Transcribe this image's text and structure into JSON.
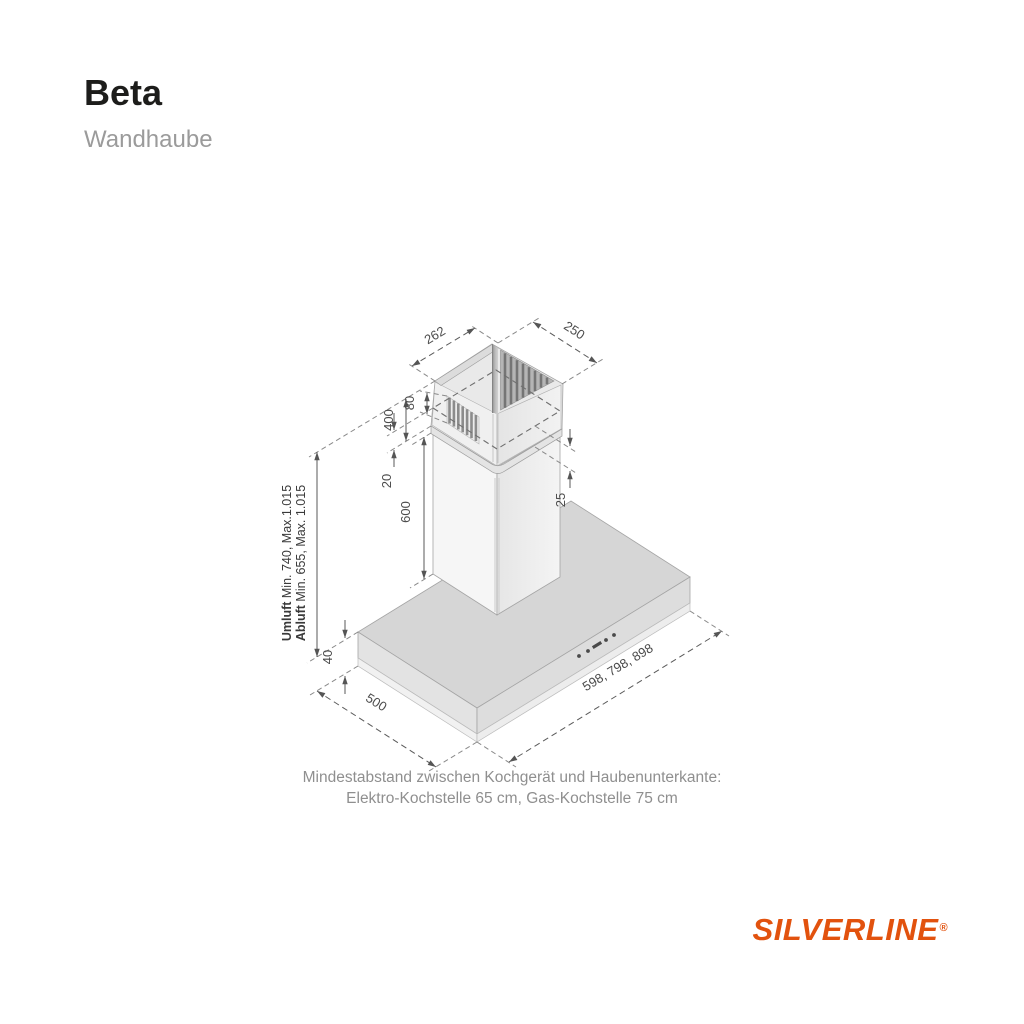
{
  "header": {
    "title": "Beta",
    "subtitle": "Wandhaube"
  },
  "diagram": {
    "dim_duct_depth": "262",
    "dim_duct_width": "250",
    "dim_vent_height": "80",
    "dim_upper_section": "400",
    "dim_overlap_left": "20",
    "dim_overlap_right": "25",
    "dim_lower_section": "600",
    "dim_body_height": "40",
    "dim_body_depth": "500",
    "dim_body_widths": "598, 798, 898",
    "height_umluft_bold": "Umluft",
    "height_umluft_rest": " Min. 740, Max.1.015",
    "height_abluft_bold": "Abluft",
    "height_abluft_rest": " Min. 655, Max. 1.015"
  },
  "note": {
    "line1": "Mindestabstand zwischen Kochgerät und Haubenunterkante:",
    "line2": "Elektro-Kochstelle 65 cm, Gas-Kochstelle 75 cm"
  },
  "brand": {
    "name": "SILVERLINE",
    "registered": "®",
    "color": "#e2520e"
  }
}
